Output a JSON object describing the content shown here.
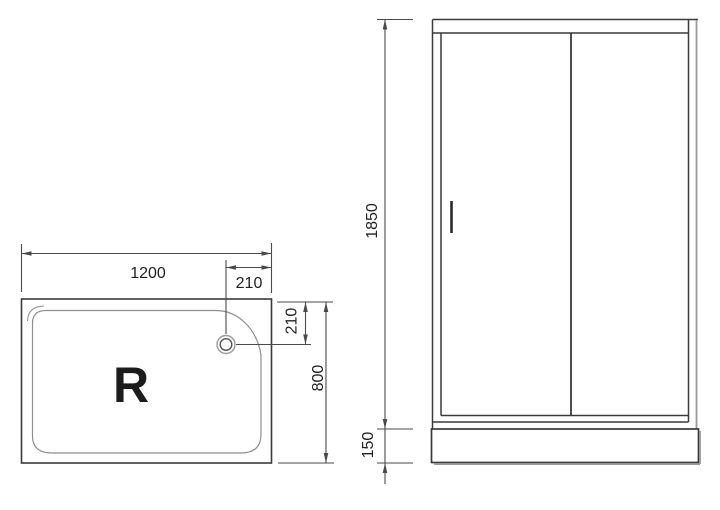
{
  "views": {
    "tray_top": {
      "label": "R",
      "dimensions": {
        "width": "1200",
        "drain_from_right": "210",
        "drain_from_top": "210",
        "depth": "800"
      }
    },
    "cabin_front": {
      "dimensions": {
        "height": "1850",
        "tray_height": "150"
      }
    }
  },
  "icons": {
    "drain": "drain-icon",
    "door_handle": "door-handle"
  },
  "colors": {
    "background": "#ffffff",
    "object_line": "#3a3a3a",
    "dimension_line": "#4a4a4a",
    "thin_line": "#8e8e8e",
    "shadow_line": "#9a9a9a",
    "text": "#1f1f1f"
  }
}
